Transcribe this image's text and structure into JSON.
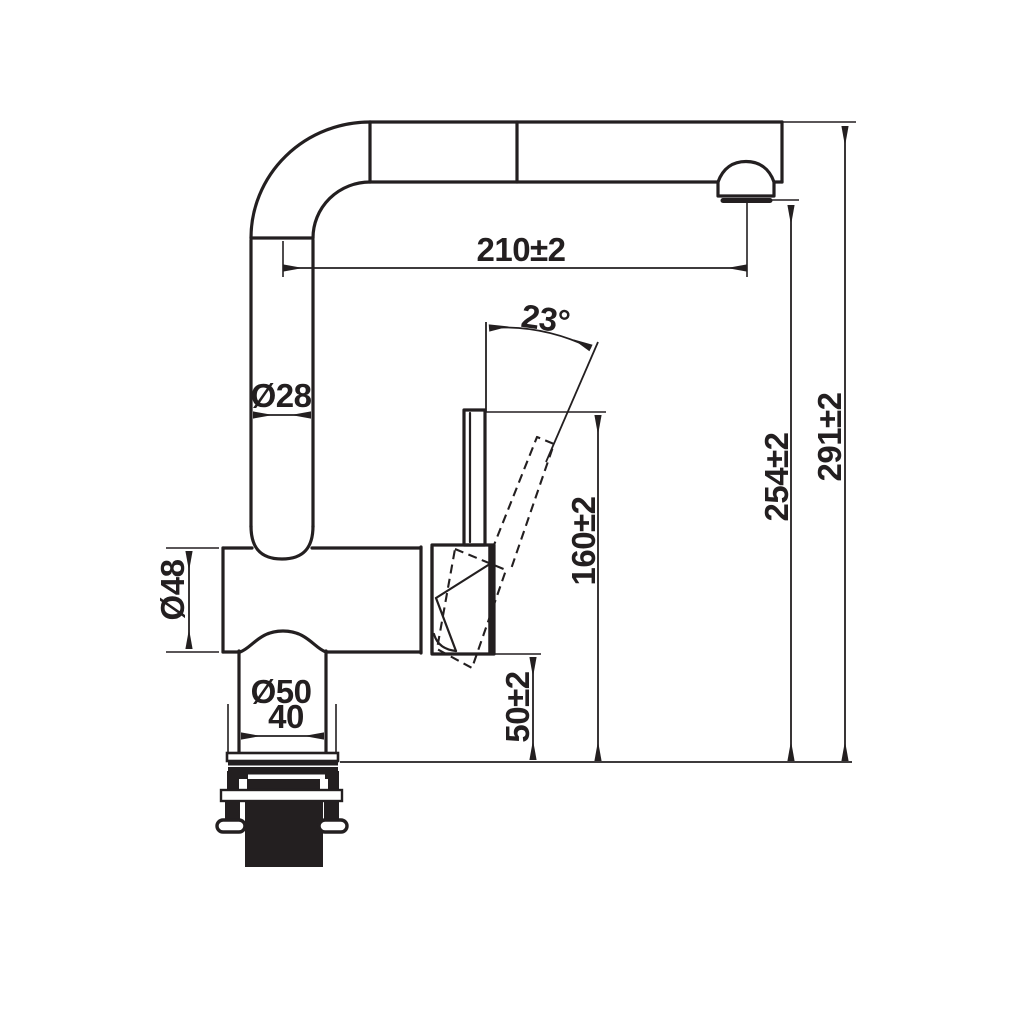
{
  "drawing": {
    "type": "faucet-technical-dimension-drawing",
    "background_color": "#ffffff",
    "line_color": "#231f20"
  },
  "dimensions": {
    "reach": {
      "label": "210±2"
    },
    "angle": {
      "label": "23°"
    },
    "spout_pipe_diameter": {
      "label": "Ø28"
    },
    "body_diameter": {
      "label": "Ø48"
    },
    "base_flange_diameter": {
      "label": "Ø50"
    },
    "base_neck_width": {
      "label": "40"
    },
    "handle_top_height": {
      "label": "160±2"
    },
    "handle_bottom_height": {
      "label": "50±2"
    },
    "outlet_height": {
      "label": "254±2"
    },
    "total_height": {
      "label": "291±2"
    }
  }
}
